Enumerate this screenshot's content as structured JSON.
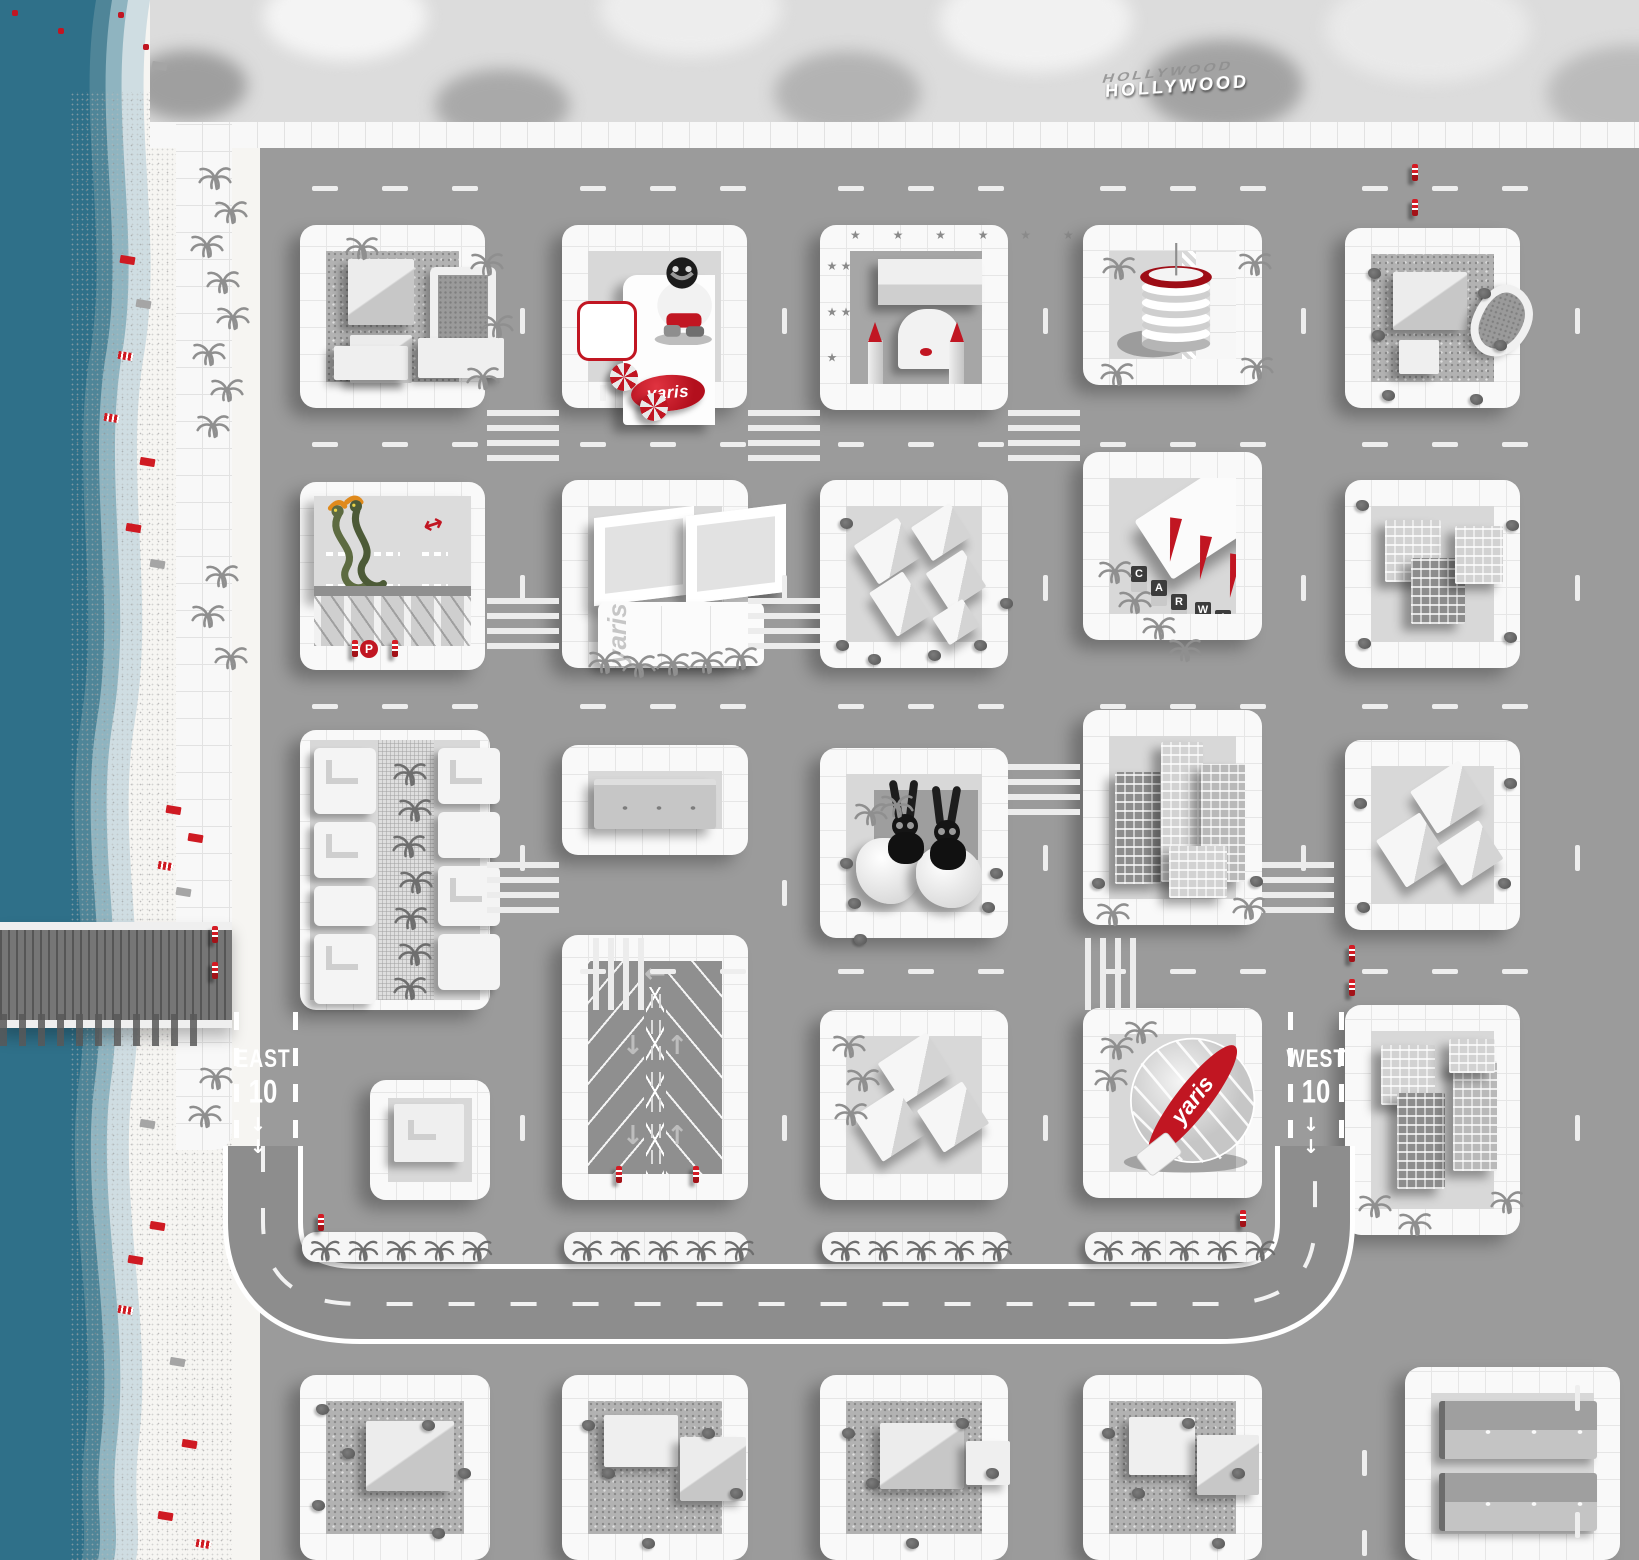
{
  "signs": {
    "hollywood": "HOLLYWOOD",
    "east": {
      "label": "EAST",
      "route": "10",
      "arrows": "↓ ↓"
    },
    "west": {
      "label": "WEST",
      "route": "10",
      "arrows": "↓ ↓"
    },
    "parking_badge": "P"
  },
  "brand": {
    "name": "yaris",
    "accent": "#c11622"
  },
  "carwash": {
    "letters": [
      "C",
      "A",
      "R",
      "W",
      "A",
      "S",
      "H"
    ]
  },
  "parking_lot": {
    "arrow_left": "←",
    "arrow_down": "↓",
    "arrow_up": "↑"
  },
  "walk_of_fame": {
    "stars_top": "★ ★ ★ ★ ★ ★",
    "stars_side": "★ ★ ★ ★ ★"
  },
  "snake_garage": {
    "two_way_arrow": "↔"
  },
  "colors": {
    "road": "#9b9b9b",
    "block_lot": "#d8d8d8",
    "sidewalk": "#f8f8f8",
    "ocean_deep": "#2f7089",
    "sand": "#f6f5f2",
    "accent_red": "#c11622",
    "freeway": "#8d8d8d",
    "lawn": "#b2b2b2"
  }
}
